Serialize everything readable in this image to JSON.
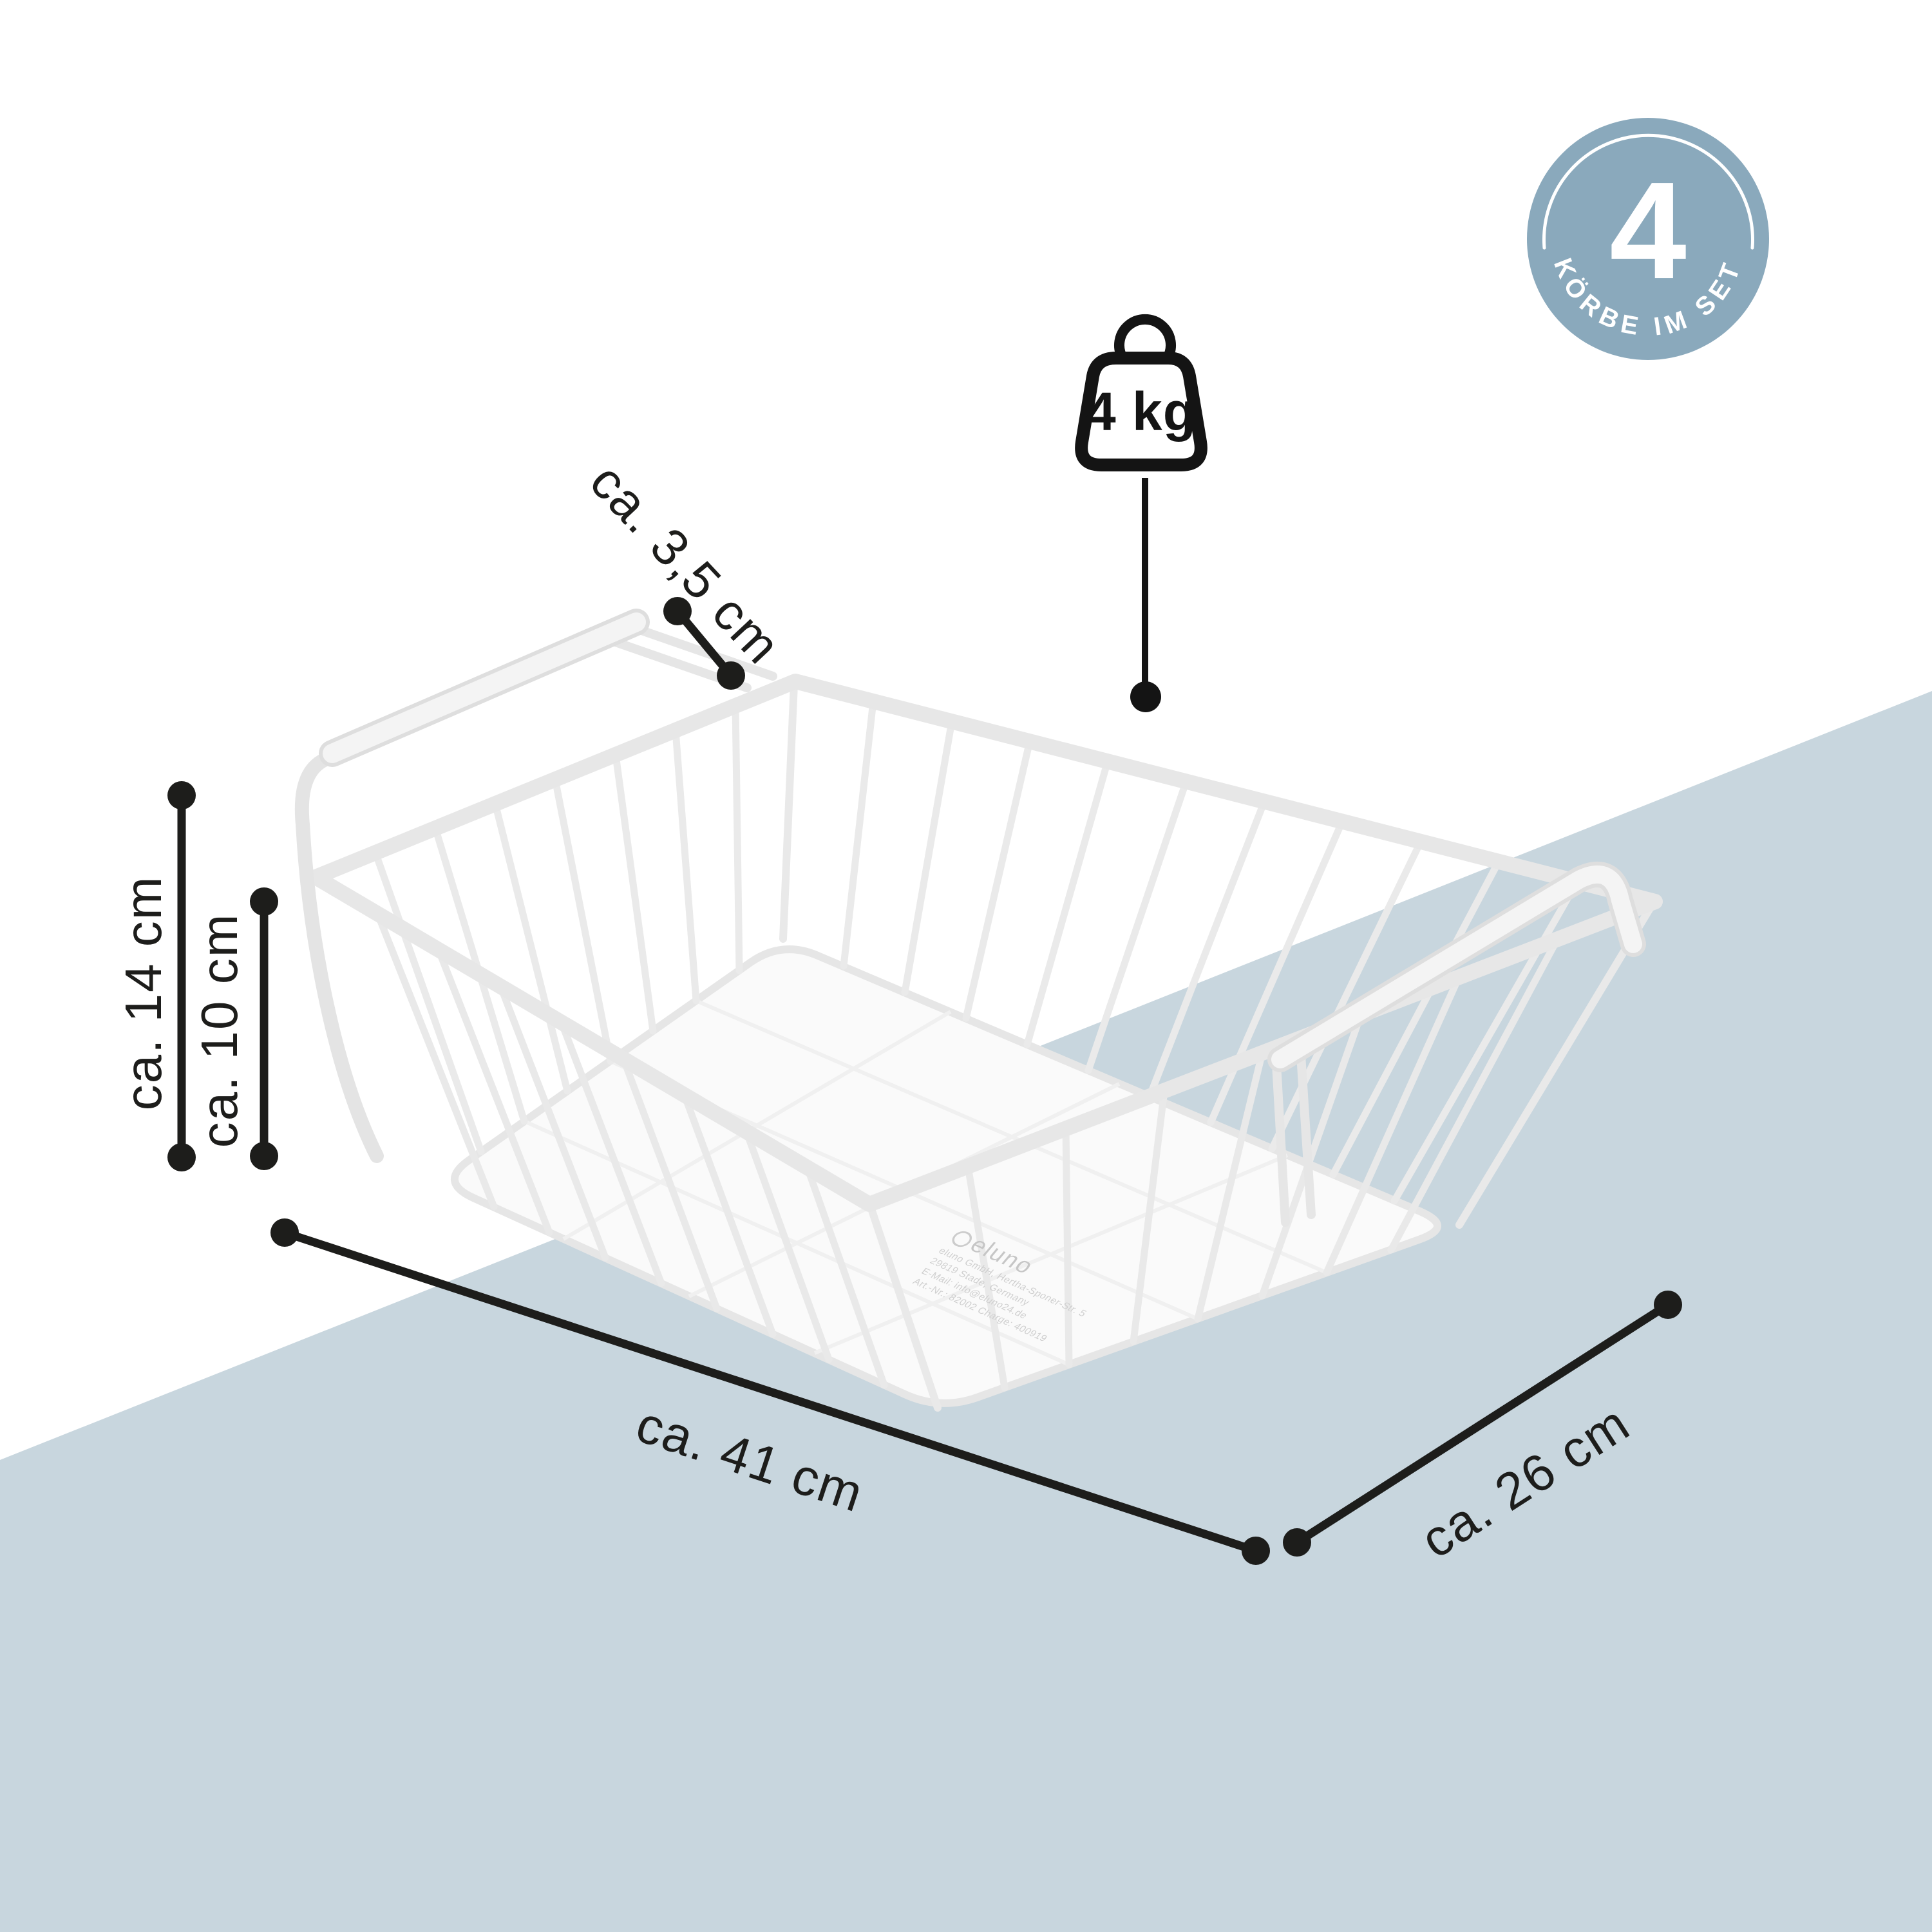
{
  "badge": {
    "count": "4",
    "label": "KÖRBE IM SET"
  },
  "weight_icon": {
    "label": "4 kg"
  },
  "dimension_labels": {
    "hook_height": "ca. 3,5 cm",
    "total_height": "ca. 14 cm",
    "basket_height": "ca. 10 cm",
    "length": "ca. 41 cm",
    "depth": "ca. 26 cm"
  },
  "base_print": {
    "brand": "eluno",
    "line_1": "eluno GmbH, Hertha-Sponer-Str. 5",
    "line_2": "29819 Stade, Germany",
    "line_3": "E-Mail: info@eluno24.de",
    "line_4": "Art.-Nr.: 82002   Charge: 400919"
  },
  "colors": {
    "accent_band": "#c8d6de",
    "badge_fill": "#8aa9bc",
    "annotation": "#1d1d1b",
    "basket_white": "#ffffff"
  }
}
